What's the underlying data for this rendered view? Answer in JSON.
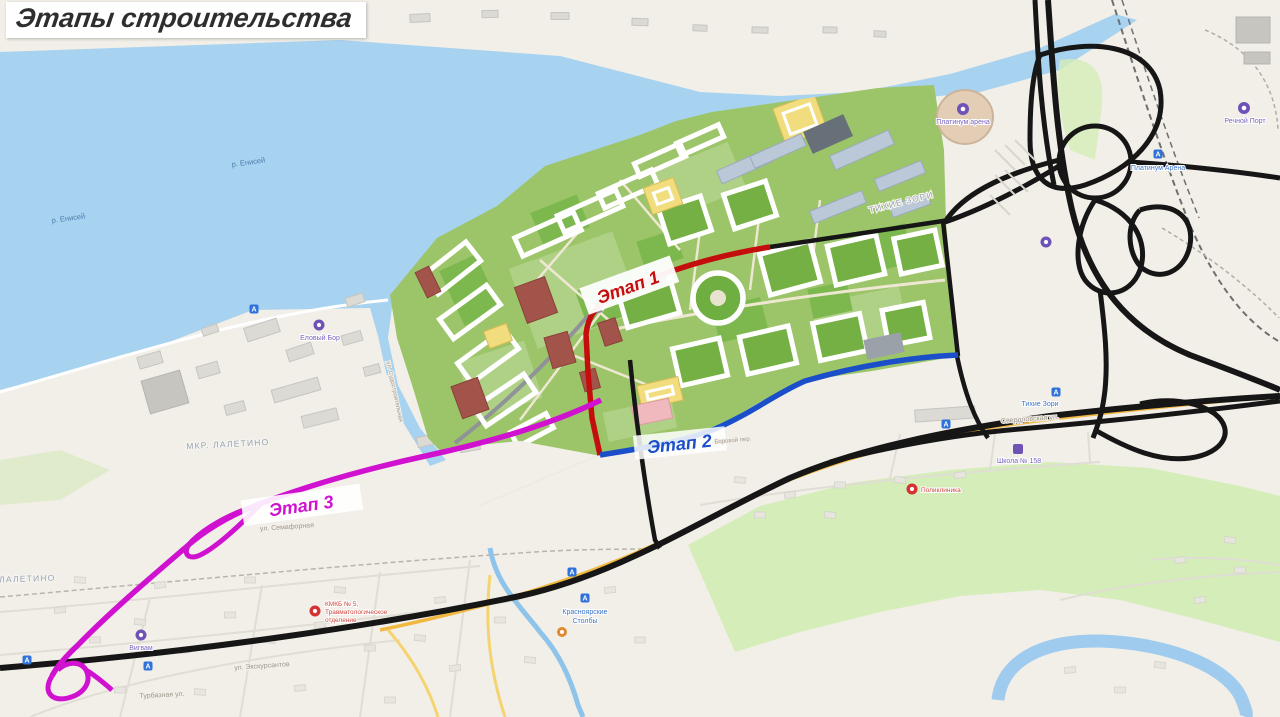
{
  "title": "Этапы строительства",
  "stages": [
    {
      "label": "Этап 1",
      "color": "#c40d0d"
    },
    {
      "label": "Этап 2",
      "color": "#1a4fc9"
    },
    {
      "label": "Этап 3",
      "color": "#d012d0"
    }
  ],
  "labels": {
    "river1": "р. Енисей",
    "river2": "р. Енисей",
    "district_laletino": "МКР. ЛАЛЕТИНО",
    "district_laletino2": "МКР. ЛАЛЕТИНО",
    "district_tihie_zori": "ТИХИЕ ЗОРИ",
    "poi_stadium": "Платинум арена",
    "poi_river_port": "Речной Порт",
    "poi_elovy_bor": "Еловый Бор",
    "poi_vigvam": "Вигвам",
    "poi_polyclinic": "Поликлиника",
    "poi_hospital1": "КМКБ № 5,",
    "poi_hospital2": "Травматологическое",
    "poi_hospital3": "отделение",
    "poi_school": "Школа № 158",
    "transit_stolby1": "Красноярские",
    "transit_stolby2": "Столбы",
    "transit_platinum": "Платинум Арена",
    "transit_tihie": "Тихие Зори",
    "street_sverdlovskaya": "Свердловская ул.",
    "street_semafornaya": "ул. Семафорная",
    "street_sudostroit": "ул. Судостроительная",
    "street_ekskursantov": "ул. Экскурсантов",
    "street_turbaznaya": "Турбазная ул.",
    "street_borovoy": "Боровой пер."
  },
  "icons": {
    "transit_glyph": "А",
    "medical_glyph": "+"
  },
  "colors": {
    "water": "#a8d3f0",
    "road": "#161616",
    "stage1": "#c40d0d",
    "stage2": "#1a4fc9",
    "stage3": "#d012d0",
    "greenfield": "#d5edb8",
    "masterplan_green": "#9cc468"
  }
}
